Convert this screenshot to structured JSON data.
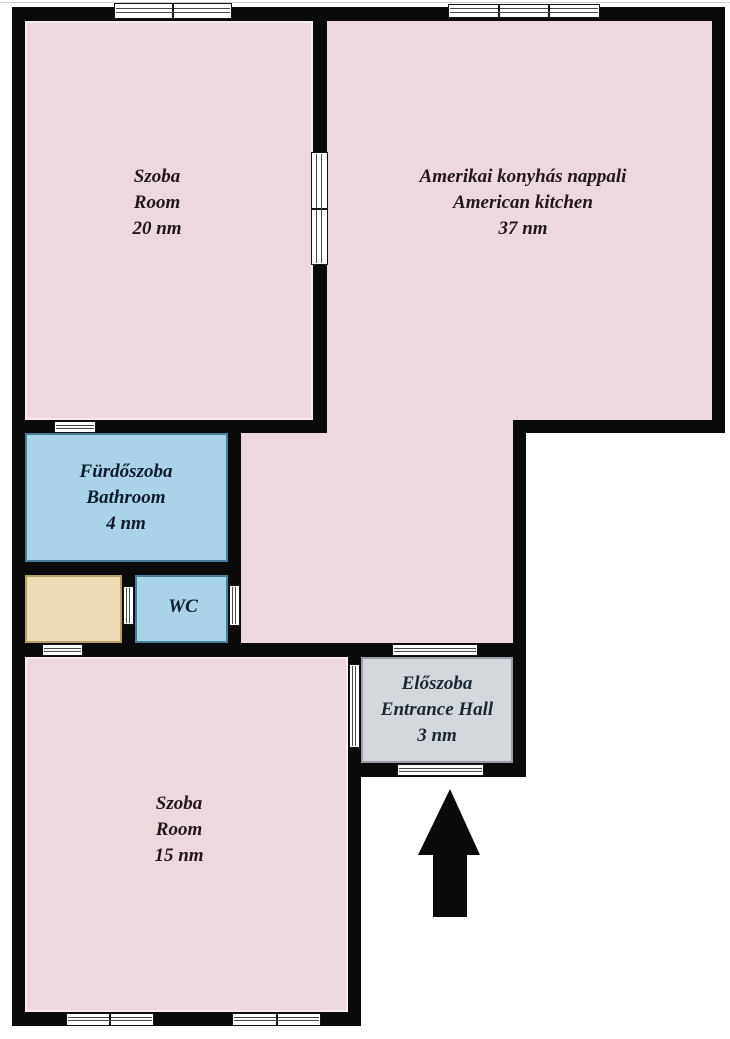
{
  "page": {
    "type": "floor-plan",
    "canvas": {
      "width": 730,
      "height": 1039,
      "background": "#ffffff"
    },
    "wall_color": "#0a0a0a",
    "opening_frame_color": "#141414",
    "opening_line_color": "#4a4a4a",
    "arrow_color": "#0a0a0a"
  },
  "plan": {
    "rooms": [
      {
        "id": "room-szoba-20",
        "label_lines": [
          "Szoba",
          "Room",
          "20 nm"
        ],
        "fill": "#edd8de",
        "border": "#f7edf0",
        "text_color": "#1f171b",
        "rects": [
          {
            "x": 25,
            "y": 21,
            "w": 288,
            "h": 399
          }
        ],
        "label_center": {
          "x": 157,
          "y": 203
        }
      },
      {
        "id": "room-american-kitchen",
        "label_lines": [
          "Amerikai konyhás nappali",
          "American kitchen",
          "37 nm"
        ],
        "fill": "#edd8de",
        "border": "#edd8de",
        "text_color": "#1f171b",
        "rects": [
          {
            "x": 327,
            "y": 21,
            "w": 385,
            "h": 399
          },
          {
            "x": 241,
            "y": 420,
            "w": 272,
            "h": 223
          }
        ],
        "label_center": {
          "x": 523,
          "y": 203
        }
      },
      {
        "id": "room-bathroom",
        "label_lines": [
          "Fürdőszoba",
          "Bathroom",
          "4 nm"
        ],
        "fill": "#a9d3e7",
        "border": "#4a7b97",
        "text_color": "#0d1c2b",
        "rects": [
          {
            "x": 25,
            "y": 433,
            "w": 203,
            "h": 129
          }
        ],
        "label_center": {
          "x": 126,
          "y": 498
        }
      },
      {
        "id": "room-storage",
        "label_lines": [],
        "fill": "#ecdcb3",
        "border": "#b7a165",
        "text_color": "#1f171b",
        "rects": [
          {
            "x": 25,
            "y": 575,
            "w": 97,
            "h": 68
          }
        ],
        "label_center": null
      },
      {
        "id": "room-wc",
        "label_lines": [
          "WC"
        ],
        "fill": "#a9d3e7",
        "border": "#4a7b97",
        "text_color": "#0d1c2b",
        "rects": [
          {
            "x": 135,
            "y": 575,
            "w": 93,
            "h": 68
          }
        ],
        "label_center": {
          "x": 183,
          "y": 607
        }
      },
      {
        "id": "room-entrance-hall",
        "label_lines": [
          "Előszoba",
          "Entrance Hall",
          "3 nm"
        ],
        "fill": "#d4d8dd",
        "border": "#989ea7",
        "text_color": "#1c2734",
        "rects": [
          {
            "x": 361,
            "y": 657,
            "w": 152,
            "h": 106
          }
        ],
        "label_center": {
          "x": 437,
          "y": 710
        }
      },
      {
        "id": "room-szoba-15",
        "label_lines": [
          "Szoba",
          "Room",
          "15 nm"
        ],
        "fill": "#edd8de",
        "border": "#f7edf0",
        "text_color": "#1f171b",
        "rects": [
          {
            "x": 25,
            "y": 657,
            "w": 323,
            "h": 355
          }
        ],
        "label_center": {
          "x": 179,
          "y": 830
        }
      }
    ],
    "walls": [
      {
        "id": "wall-top",
        "x": 12,
        "y": 7,
        "w": 713,
        "h": 14
      },
      {
        "id": "wall-left",
        "x": 12,
        "y": 7,
        "w": 13,
        "h": 1019
      },
      {
        "id": "wall-right",
        "x": 712,
        "y": 7,
        "w": 13,
        "h": 426
      },
      {
        "id": "wall-divider-szoba20-kitchen",
        "x": 313,
        "y": 7,
        "w": 14,
        "h": 426
      },
      {
        "id": "wall-szoba20-bottom",
        "x": 12,
        "y": 420,
        "w": 315,
        "h": 13
      },
      {
        "id": "wall-kitchen-bottom",
        "x": 513,
        "y": 420,
        "w": 212,
        "h": 13
      },
      {
        "id": "wall-bathroom-bottom",
        "x": 12,
        "y": 562,
        "w": 229,
        "h": 13
      },
      {
        "id": "wall-bathroom-right",
        "x": 228,
        "y": 420,
        "w": 13,
        "h": 237
      },
      {
        "id": "wall-storage-wc-divider",
        "x": 122,
        "y": 575,
        "w": 13,
        "h": 82
      },
      {
        "id": "wall-corridor-bottom",
        "x": 12,
        "y": 643,
        "w": 514,
        "h": 14
      },
      {
        "id": "wall-entrance-right",
        "x": 513,
        "y": 433,
        "w": 13,
        "h": 344
      },
      {
        "id": "wall-szoba15-right",
        "x": 348,
        "y": 657,
        "w": 13,
        "h": 369
      },
      {
        "id": "wall-entrance-bottom",
        "x": 348,
        "y": 763,
        "w": 178,
        "h": 14
      },
      {
        "id": "wall-szoba15-bottom",
        "x": 12,
        "y": 1012,
        "w": 349,
        "h": 14
      }
    ],
    "openings": [
      {
        "id": "window-top-left",
        "x": 114,
        "y": 3,
        "w": 118,
        "h": 16,
        "orient": "h",
        "dividers": 1
      },
      {
        "id": "window-top-right",
        "x": 448,
        "y": 4,
        "w": 152,
        "h": 14,
        "orient": "h",
        "dividers": 2
      },
      {
        "id": "door-szoba20-kitchen",
        "x": 311,
        "y": 152,
        "w": 17,
        "h": 113,
        "orient": "v",
        "dividers": 1
      },
      {
        "id": "window-bathroom",
        "x": 54,
        "y": 421,
        "w": 42,
        "h": 12,
        "orient": "h",
        "dividers": 0
      },
      {
        "id": "door-storage-wc",
        "x": 123,
        "y": 586,
        "w": 11,
        "h": 39,
        "orient": "v",
        "dividers": 0
      },
      {
        "id": "door-wc-corridor",
        "x": 229,
        "y": 585,
        "w": 11,
        "h": 41,
        "orient": "v",
        "dividers": 0
      },
      {
        "id": "window-storage",
        "x": 42,
        "y": 644,
        "w": 41,
        "h": 12,
        "orient": "h",
        "dividers": 0
      },
      {
        "id": "door-living-entrance",
        "x": 392,
        "y": 644,
        "w": 86,
        "h": 12,
        "orient": "h",
        "dividers": 0
      },
      {
        "id": "door-entrance-szoba15",
        "x": 349,
        "y": 664,
        "w": 11,
        "h": 84,
        "orient": "v",
        "dividers": 0
      },
      {
        "id": "door-main-entrance",
        "x": 397,
        "y": 764,
        "w": 87,
        "h": 12,
        "orient": "h",
        "dividers": 0
      },
      {
        "id": "window-szoba15-left",
        "x": 66,
        "y": 1013,
        "w": 88,
        "h": 13,
        "orient": "h",
        "dividers": 1
      },
      {
        "id": "window-szoba15-right",
        "x": 232,
        "y": 1013,
        "w": 89,
        "h": 13,
        "orient": "h",
        "dividers": 1
      }
    ]
  }
}
